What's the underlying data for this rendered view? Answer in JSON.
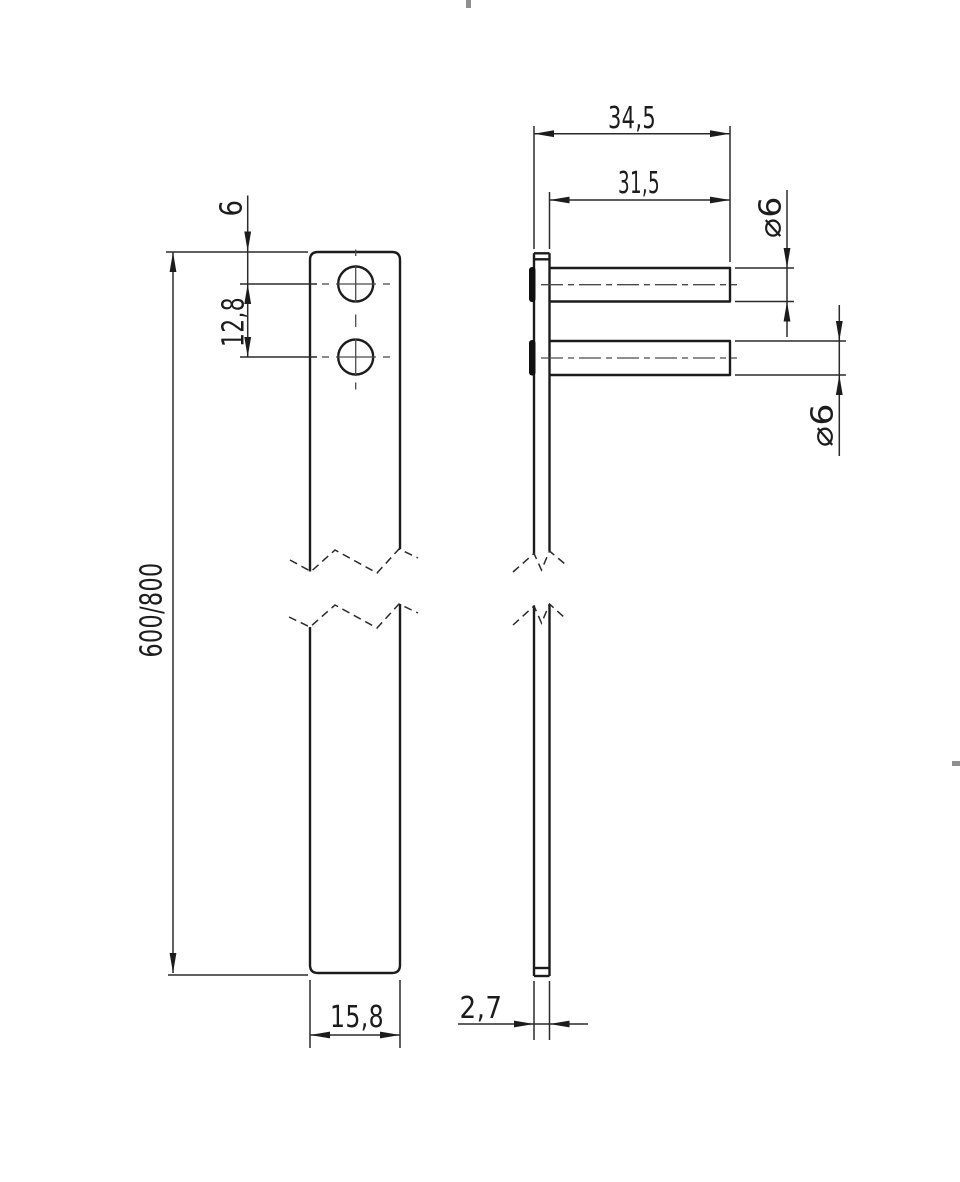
{
  "drawing": {
    "type": "technical-drawing-two-views-broken-part",
    "dims": {
      "pin_overall": "34,5",
      "pin_length": "31,5",
      "pin_dia_top": "⌀6",
      "pin_dia_bottom": "⌀6",
      "edge_to_first_hole": "6",
      "hole_spacing": "12,8",
      "part_length": "600/800",
      "part_width": "15,8",
      "part_thickness": "2,7"
    },
    "colors": {
      "outline": "#1c1c1c",
      "dimension": "#2b2b2b",
      "centerline": "#4a4a4a",
      "frame_mark": "#8f8f8f",
      "background": "#ffffff"
    }
  }
}
